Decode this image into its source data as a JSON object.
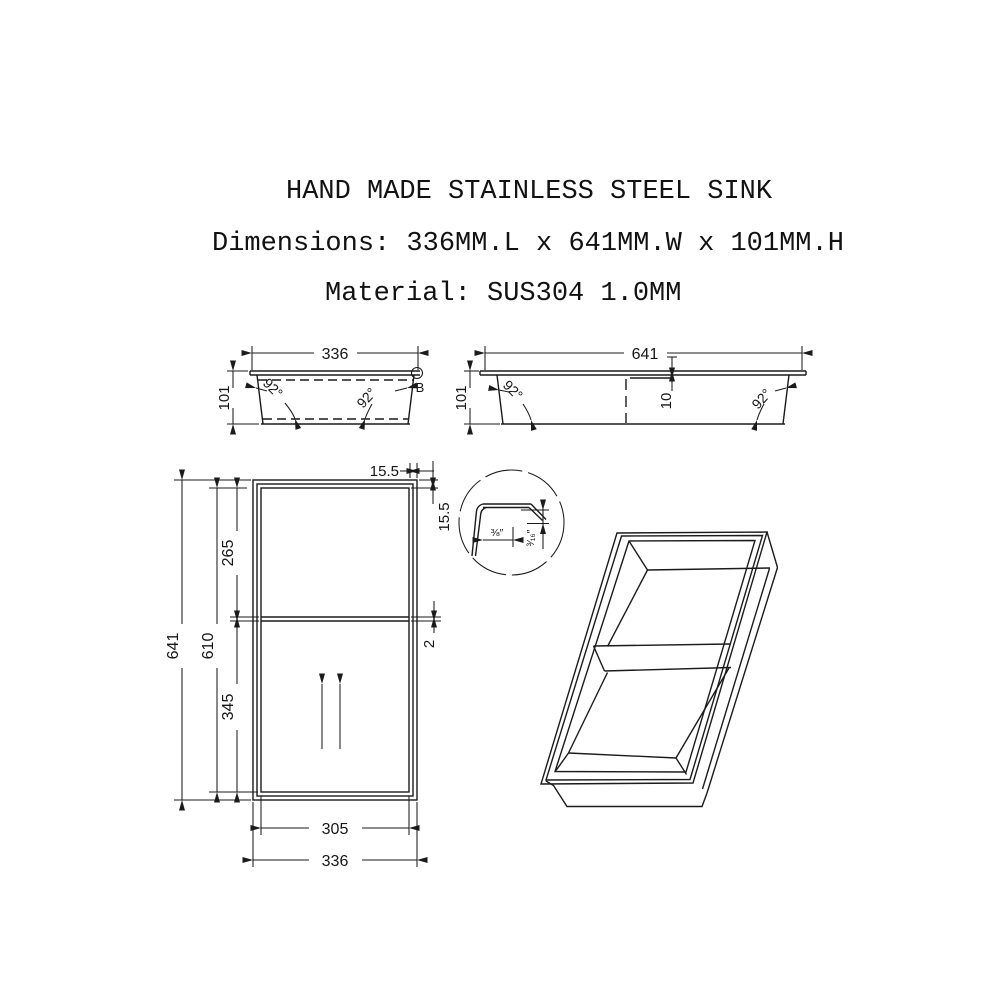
{
  "header": {
    "title": "HAND MADE STAINLESS STEEL SINK",
    "dimensions": "Dimensions: 336MM.L x 641MM.W x 101MM.H",
    "material": "Material: SUS304 1.0MM"
  },
  "views": {
    "front_section": {
      "width": "336",
      "height": "101",
      "angle_left": "92°",
      "angle_right": "92°",
      "detail_marker": "B"
    },
    "side_section": {
      "width": "641",
      "height": "101",
      "angle_left": "92°",
      "angle_right": "92°",
      "divider_drop": "10"
    },
    "plan": {
      "overall_height": "641",
      "inner_height": "610",
      "upper_bowl_height": "265",
      "lower_bowl_height": "345",
      "inner_width": "305",
      "overall_width": "336",
      "flange_top": "15.5",
      "flange_side": "15.5",
      "divider_thickness": "2"
    },
    "detail_b": {
      "flange_width": "⅜″",
      "flange_edge_height": "³⁄₁₆″"
    }
  },
  "colors": {
    "ink": "#1b1b1b",
    "paper": "#ffffff"
  }
}
